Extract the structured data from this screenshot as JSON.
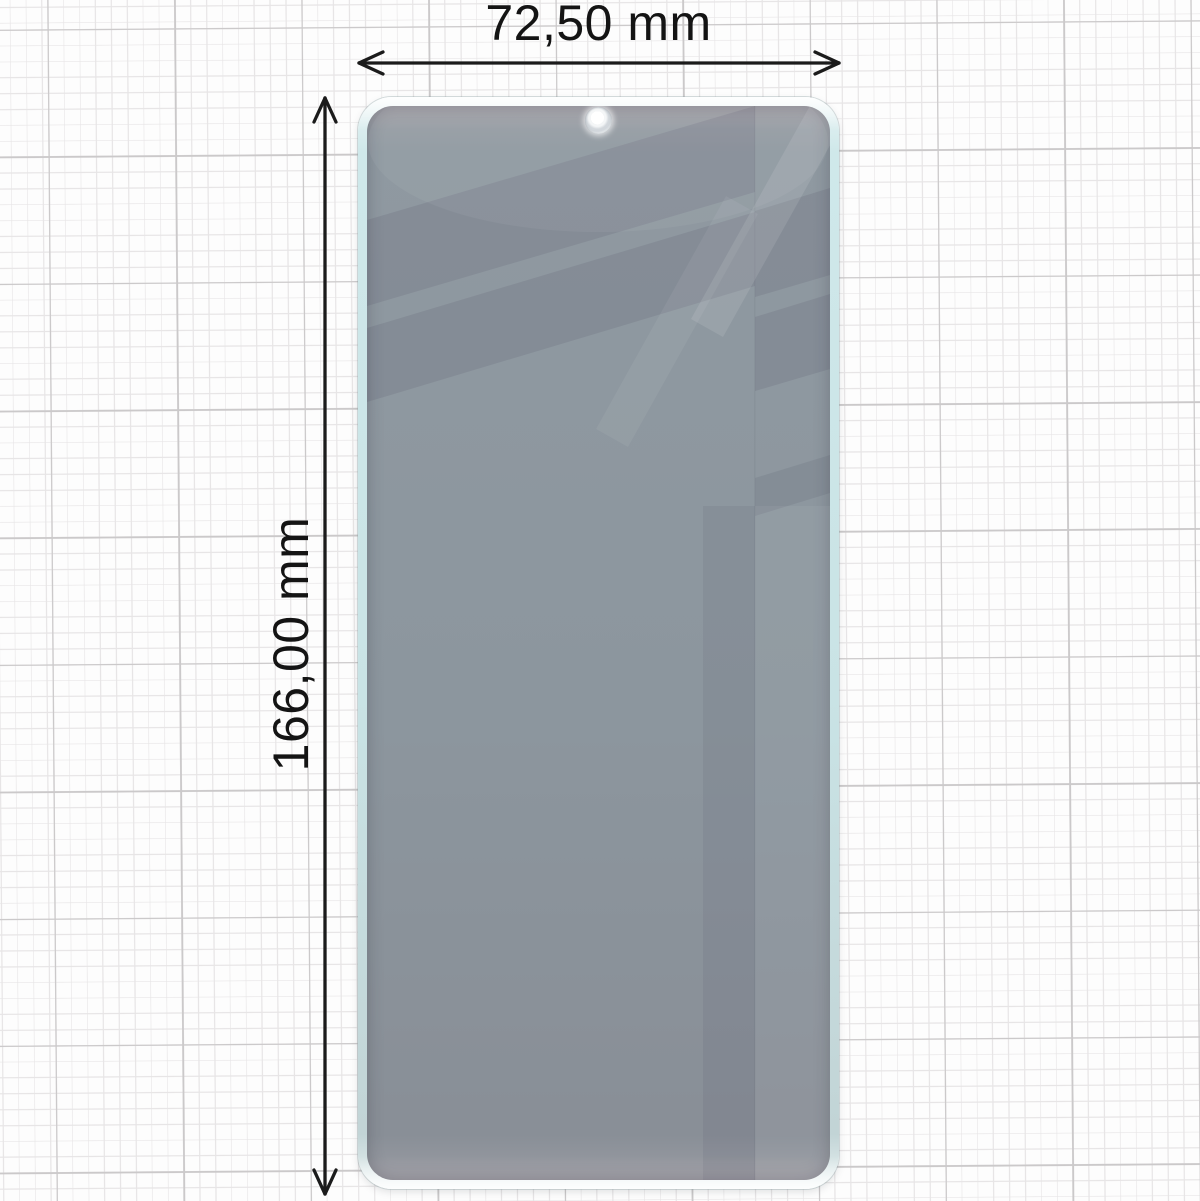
{
  "dimensions": {
    "width_label": "72,50 mm",
    "height_label": "166,00 mm"
  },
  "product": {
    "item": "privacy tempered glass screen protector",
    "camera_cutout_count": "1"
  },
  "icons": {
    "width_arrow": "double-headed-horizontal-arrow",
    "height_arrow": "double-headed-vertical-arrow",
    "camera_hole": "punch-hole-circle"
  },
  "colors": {
    "paper": "#fdfdfd",
    "grid_minor": "#e7e5e6",
    "grid_major": "#cbc9ca",
    "edge_teal": "#c9e3e5",
    "glass_tint": "#4f4957",
    "arrow": "#1b1b1b",
    "hole_ring": "#d2d7dc"
  }
}
